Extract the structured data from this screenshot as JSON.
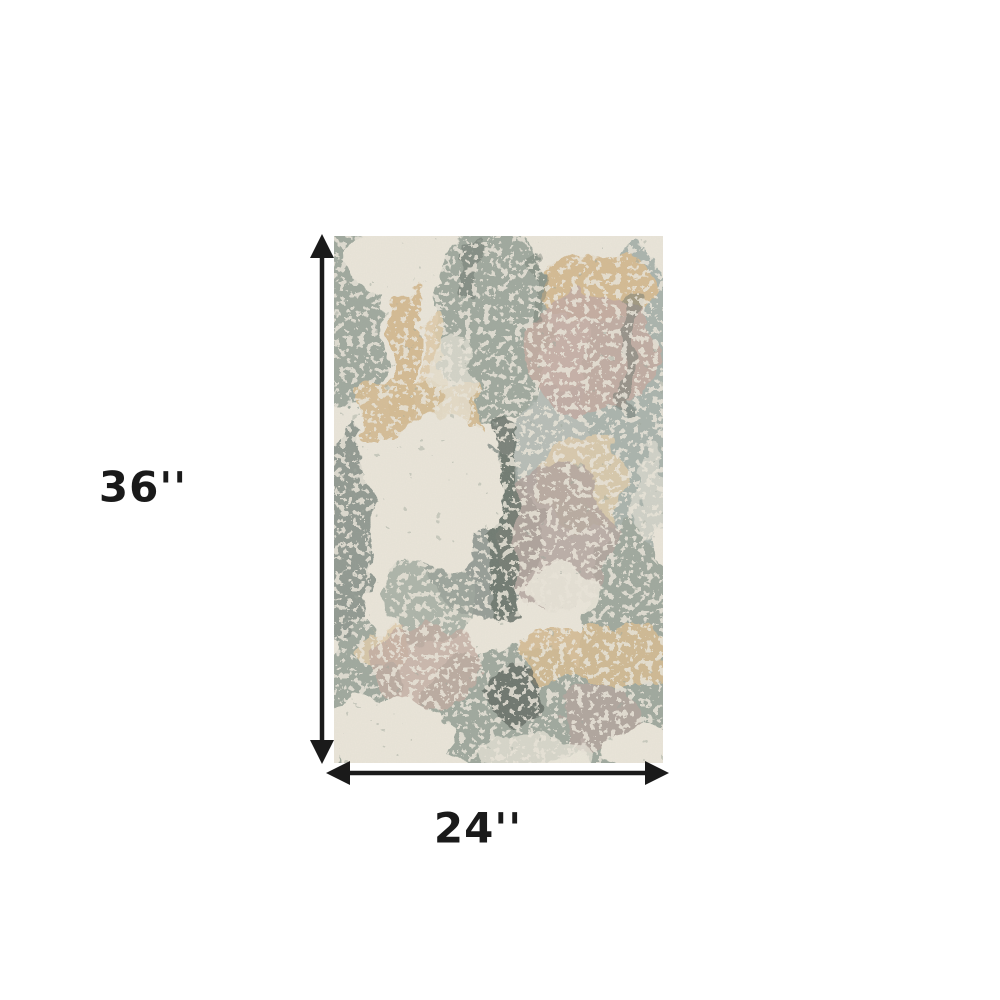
{
  "page": {
    "background": "#ffffff",
    "description": "Product dimension diagram of an abstract area rug"
  },
  "dimensions": {
    "height_label": "36''",
    "width_label": "24''"
  },
  "annotation": {
    "ink_color": "#1a1a1a",
    "vertical_arrow_icon": "double-headed-vertical-arrow",
    "horizontal_arrow_icon": "double-headed-horizontal-arrow"
  },
  "product": {
    "kind": "abstract-distressed-area-rug",
    "palette": {
      "cream": "#eae5d9",
      "sage": "#9fa89d",
      "sage_dark": "#87918a",
      "gray_blue": "#aab3ac",
      "tan": "#d4ba92",
      "tan_light": "#dfcbaa",
      "mauve": "#c2aba1",
      "mauve_gray": "#b3a49e",
      "dark_gray": "#6e776f",
      "charcoal": "#5d655f"
    }
  }
}
